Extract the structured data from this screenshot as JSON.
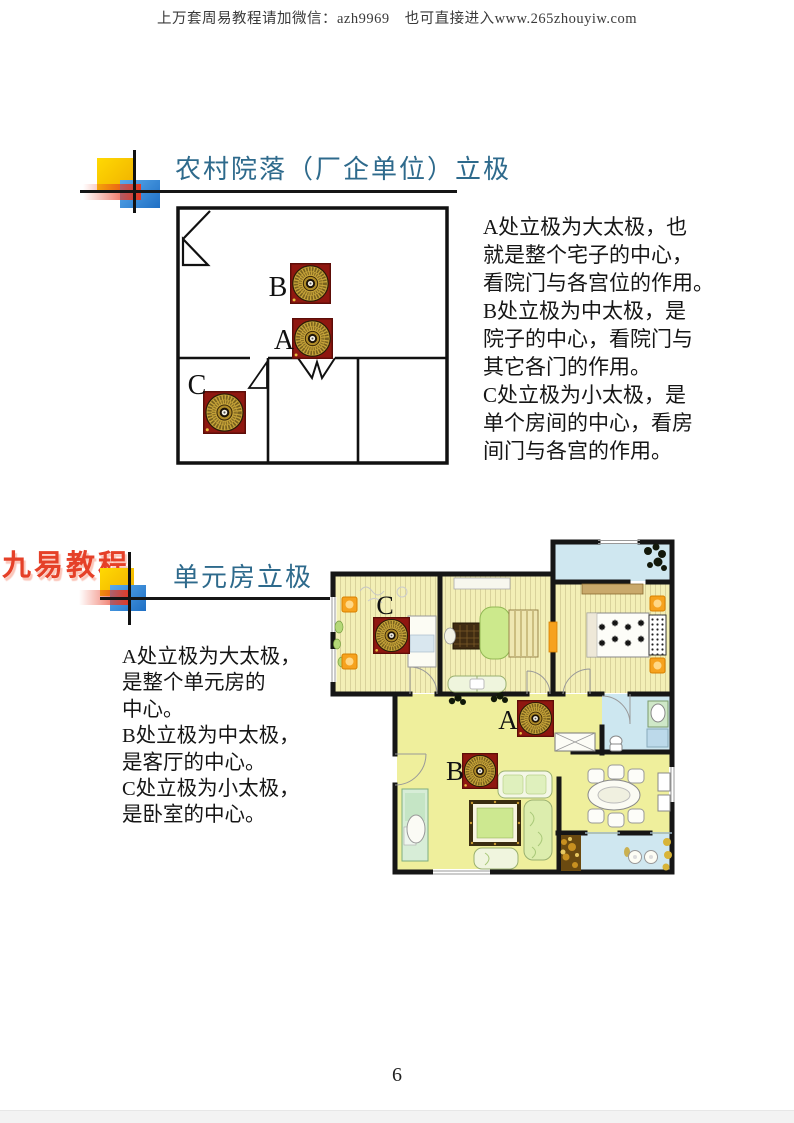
{
  "header": {
    "promo_text": "上万套周易教程请加微信：azh9969　也可直接进入www.265zhouyiw.com"
  },
  "section1": {
    "title": "农村院落（厂企单位）立极",
    "lines": [
      "A处立极为大太极，也",
      "就是整个宅子的中心，",
      "看院门与各宫位的作用。",
      "B处立极为中太极，是",
      "院子的中心，看院门与",
      "其它各门的作用。",
      "C处立极为小太极，是",
      "单个房间的中心，看房",
      "间门与各宫的作用。"
    ],
    "labels": {
      "a": "A",
      "b": "B",
      "c": "C"
    }
  },
  "section2": {
    "logo": "九易教程",
    "title": "单元房立极",
    "lines": [
      "A处立极为大太极，",
      "是整个单元房的",
      "中心。",
      "B处立极为中太极，",
      "是客厅的中心。",
      "C处立极为小太极，",
      "是卧室的中心。"
    ],
    "labels": {
      "a": "A",
      "b": "B",
      "c": "C"
    }
  },
  "footer": {
    "page_number": "6"
  },
  "colors": {
    "title_blue": "#2e6a8c",
    "logo_red": "#e54028",
    "compass_red": "#8f1710",
    "compass_gold": "#c9a63a",
    "wall_black": "#161616",
    "floor_yellow": "#efef9c",
    "floor_wood": "#f3efb6",
    "balcony_blue": "#cfe7f0",
    "lamp_orange": "#f6a21e",
    "deco_yellow": "#ffd902",
    "deco_blue": "#2f83d6",
    "deco_red": "#e83820"
  }
}
